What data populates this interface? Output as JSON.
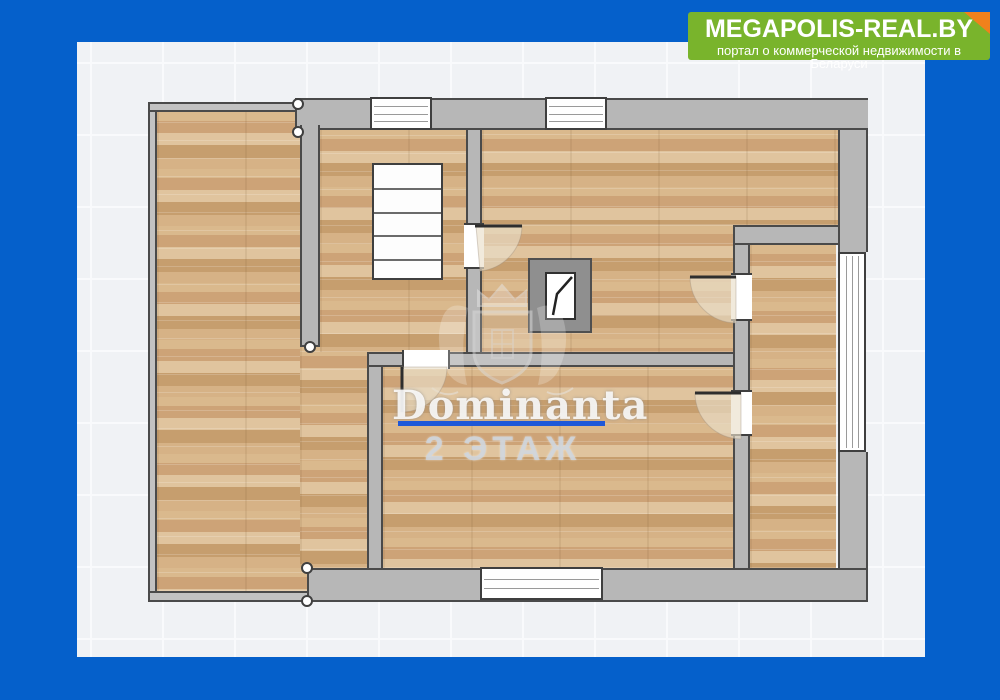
{
  "brand": {
    "title": "MEGAPOLIS-REAL.BY",
    "subtitle": "портал о коммерческой недвижимости в Беларуси",
    "bg_color": "#79b42c",
    "fold_color": "#f0811c",
    "text_color": "#ffffff"
  },
  "frame": {
    "border_color": "#0560cb",
    "canvas_color": "#f0f2f5"
  },
  "watermark": {
    "brand_name": "Dominanta",
    "floor_label": "2 ЭТАЖ",
    "underline_color": "#1e58d8",
    "crest_icon": "dominanta-crest-icon"
  },
  "palette": {
    "wall_fill": "#b7b7b7",
    "thin_wall_fill": "#c2c2c2",
    "wall_outline": "#4a4a4a",
    "floor_base": "#d2ab7e",
    "window_fill": "#ffffff",
    "door_arc_fill": "#e9dfc9",
    "chimney_fill": "#8f8f8f"
  },
  "floorplan": {
    "floors": [
      [
        157,
        112,
        150,
        479
      ],
      [
        300,
        347,
        68,
        221
      ],
      [
        320,
        130,
        146,
        222
      ],
      [
        482,
        130,
        356,
        95
      ],
      [
        482,
        225,
        251,
        127
      ],
      [
        383,
        367,
        350,
        201
      ],
      [
        750,
        245,
        86,
        323
      ]
    ],
    "walls": [
      [
        148,
        102,
        150,
        10,
        "tlb",
        "thin"
      ],
      [
        148,
        112,
        9,
        479,
        "lr",
        "thin"
      ],
      [
        148,
        591,
        159,
        11,
        "tbl",
        "thin"
      ],
      [
        295,
        98,
        573,
        32,
        "tlb",
        ""
      ],
      [
        838,
        130,
        30,
        122,
        "lr",
        ""
      ],
      [
        838,
        452,
        30,
        116,
        "lr",
        ""
      ],
      [
        307,
        568,
        561,
        34,
        "tblr",
        ""
      ],
      [
        300,
        125,
        20,
        222,
        "lrb",
        ""
      ],
      [
        466,
        130,
        16,
        93,
        "lr",
        ""
      ],
      [
        466,
        267,
        16,
        85,
        "lr",
        ""
      ],
      [
        367,
        352,
        35,
        15,
        "tlb",
        ""
      ],
      [
        450,
        352,
        287,
        15,
        "tb",
        ""
      ],
      [
        733,
        245,
        17,
        30,
        "lr",
        ""
      ],
      [
        733,
        320,
        17,
        70,
        "lr",
        ""
      ],
      [
        733,
        436,
        17,
        132,
        "lr",
        ""
      ],
      [
        733,
        225,
        105,
        20,
        "tlb",
        ""
      ],
      [
        367,
        367,
        16,
        201,
        "lr",
        ""
      ]
    ],
    "windows": [
      [
        370,
        97,
        62,
        33,
        "h",
        3
      ],
      [
        545,
        97,
        62,
        33,
        "h",
        3
      ],
      [
        838,
        252,
        28,
        200,
        "v",
        3
      ],
      [
        480,
        567,
        123,
        33,
        "h",
        2
      ]
    ],
    "door_openings": [
      [
        464,
        223,
        20,
        46,
        "tb"
      ],
      [
        402,
        350,
        48,
        19,
        "lr"
      ],
      [
        731,
        273,
        21,
        48,
        "tb"
      ],
      [
        731,
        390,
        21,
        46,
        "tb"
      ]
    ],
    "door_leaves": [
      [
        475,
        226,
        522,
        226
      ],
      [
        402,
        367,
        402,
        412
      ],
      [
        736,
        277,
        690,
        277
      ],
      [
        741,
        393,
        695,
        393
      ]
    ],
    "door_arcs": [
      "M476,226 L522,226 A46,46 0 0 1 480,271 Z",
      "M402,367 L402,412 A45,45 0 0 0 447,367 Z",
      "M736,277 L690,277 A46,46 0 0 0 736,323 Z",
      "M741,393 L695,393 A46,46 0 0 0 741,439 Z"
    ],
    "stairs": {
      "rect": [
        372,
        163,
        71,
        117
      ],
      "treads": 5
    },
    "chimney": {
      "outer": [
        528,
        258,
        64,
        75
      ],
      "inner": [
        545,
        272,
        31,
        48
      ],
      "glyph": "572,277 557,294 553,315"
    },
    "markers": [
      [
        298,
        104
      ],
      [
        298,
        132
      ],
      [
        310,
        347
      ],
      [
        307,
        568
      ],
      [
        307,
        601
      ]
    ]
  }
}
